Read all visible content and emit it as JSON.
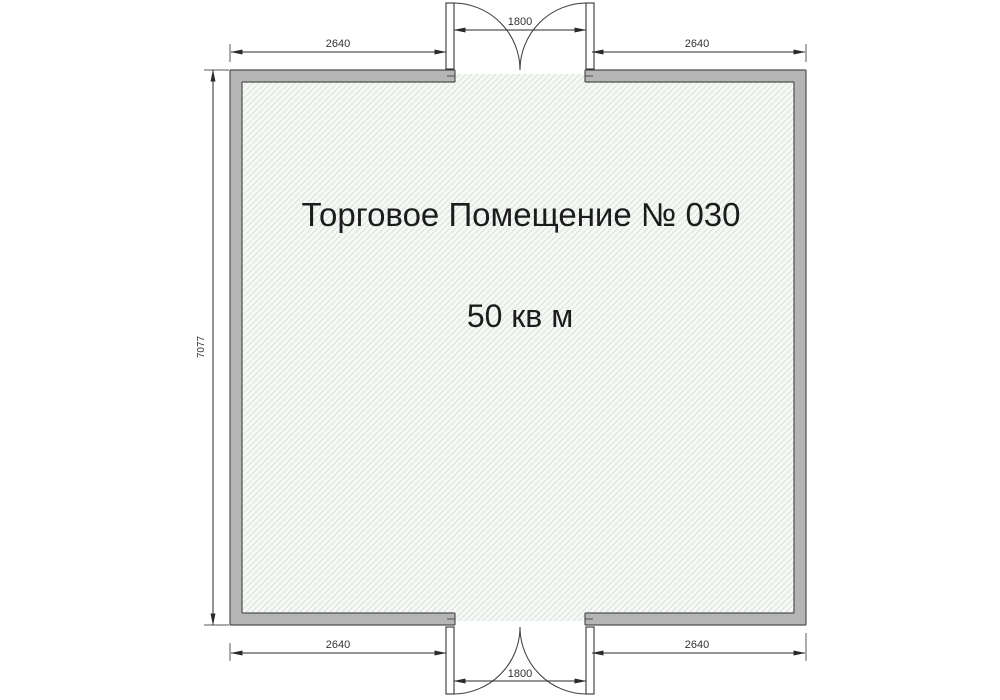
{
  "plan": {
    "room_label": "Торговое Помещение № 030",
    "area_label": "50 кв м"
  },
  "dimensions": {
    "top_left_width": "2640",
    "top_door_width": "1800",
    "top_right_width": "2640",
    "left_height": "7077",
    "bottom_left_width": "2640",
    "bottom_door_width": "1800",
    "bottom_right_width": "2640"
  },
  "colors": {
    "wall_fill": "#b5b5b5",
    "wall_stroke": "#4f4f4f",
    "hatch_line": "#d9e2d9",
    "hatch_bg": "#f6f9f6",
    "dim_line": "#2a2a2a",
    "ext_line": "#8f8f8f",
    "text": "#1c1c1c"
  }
}
